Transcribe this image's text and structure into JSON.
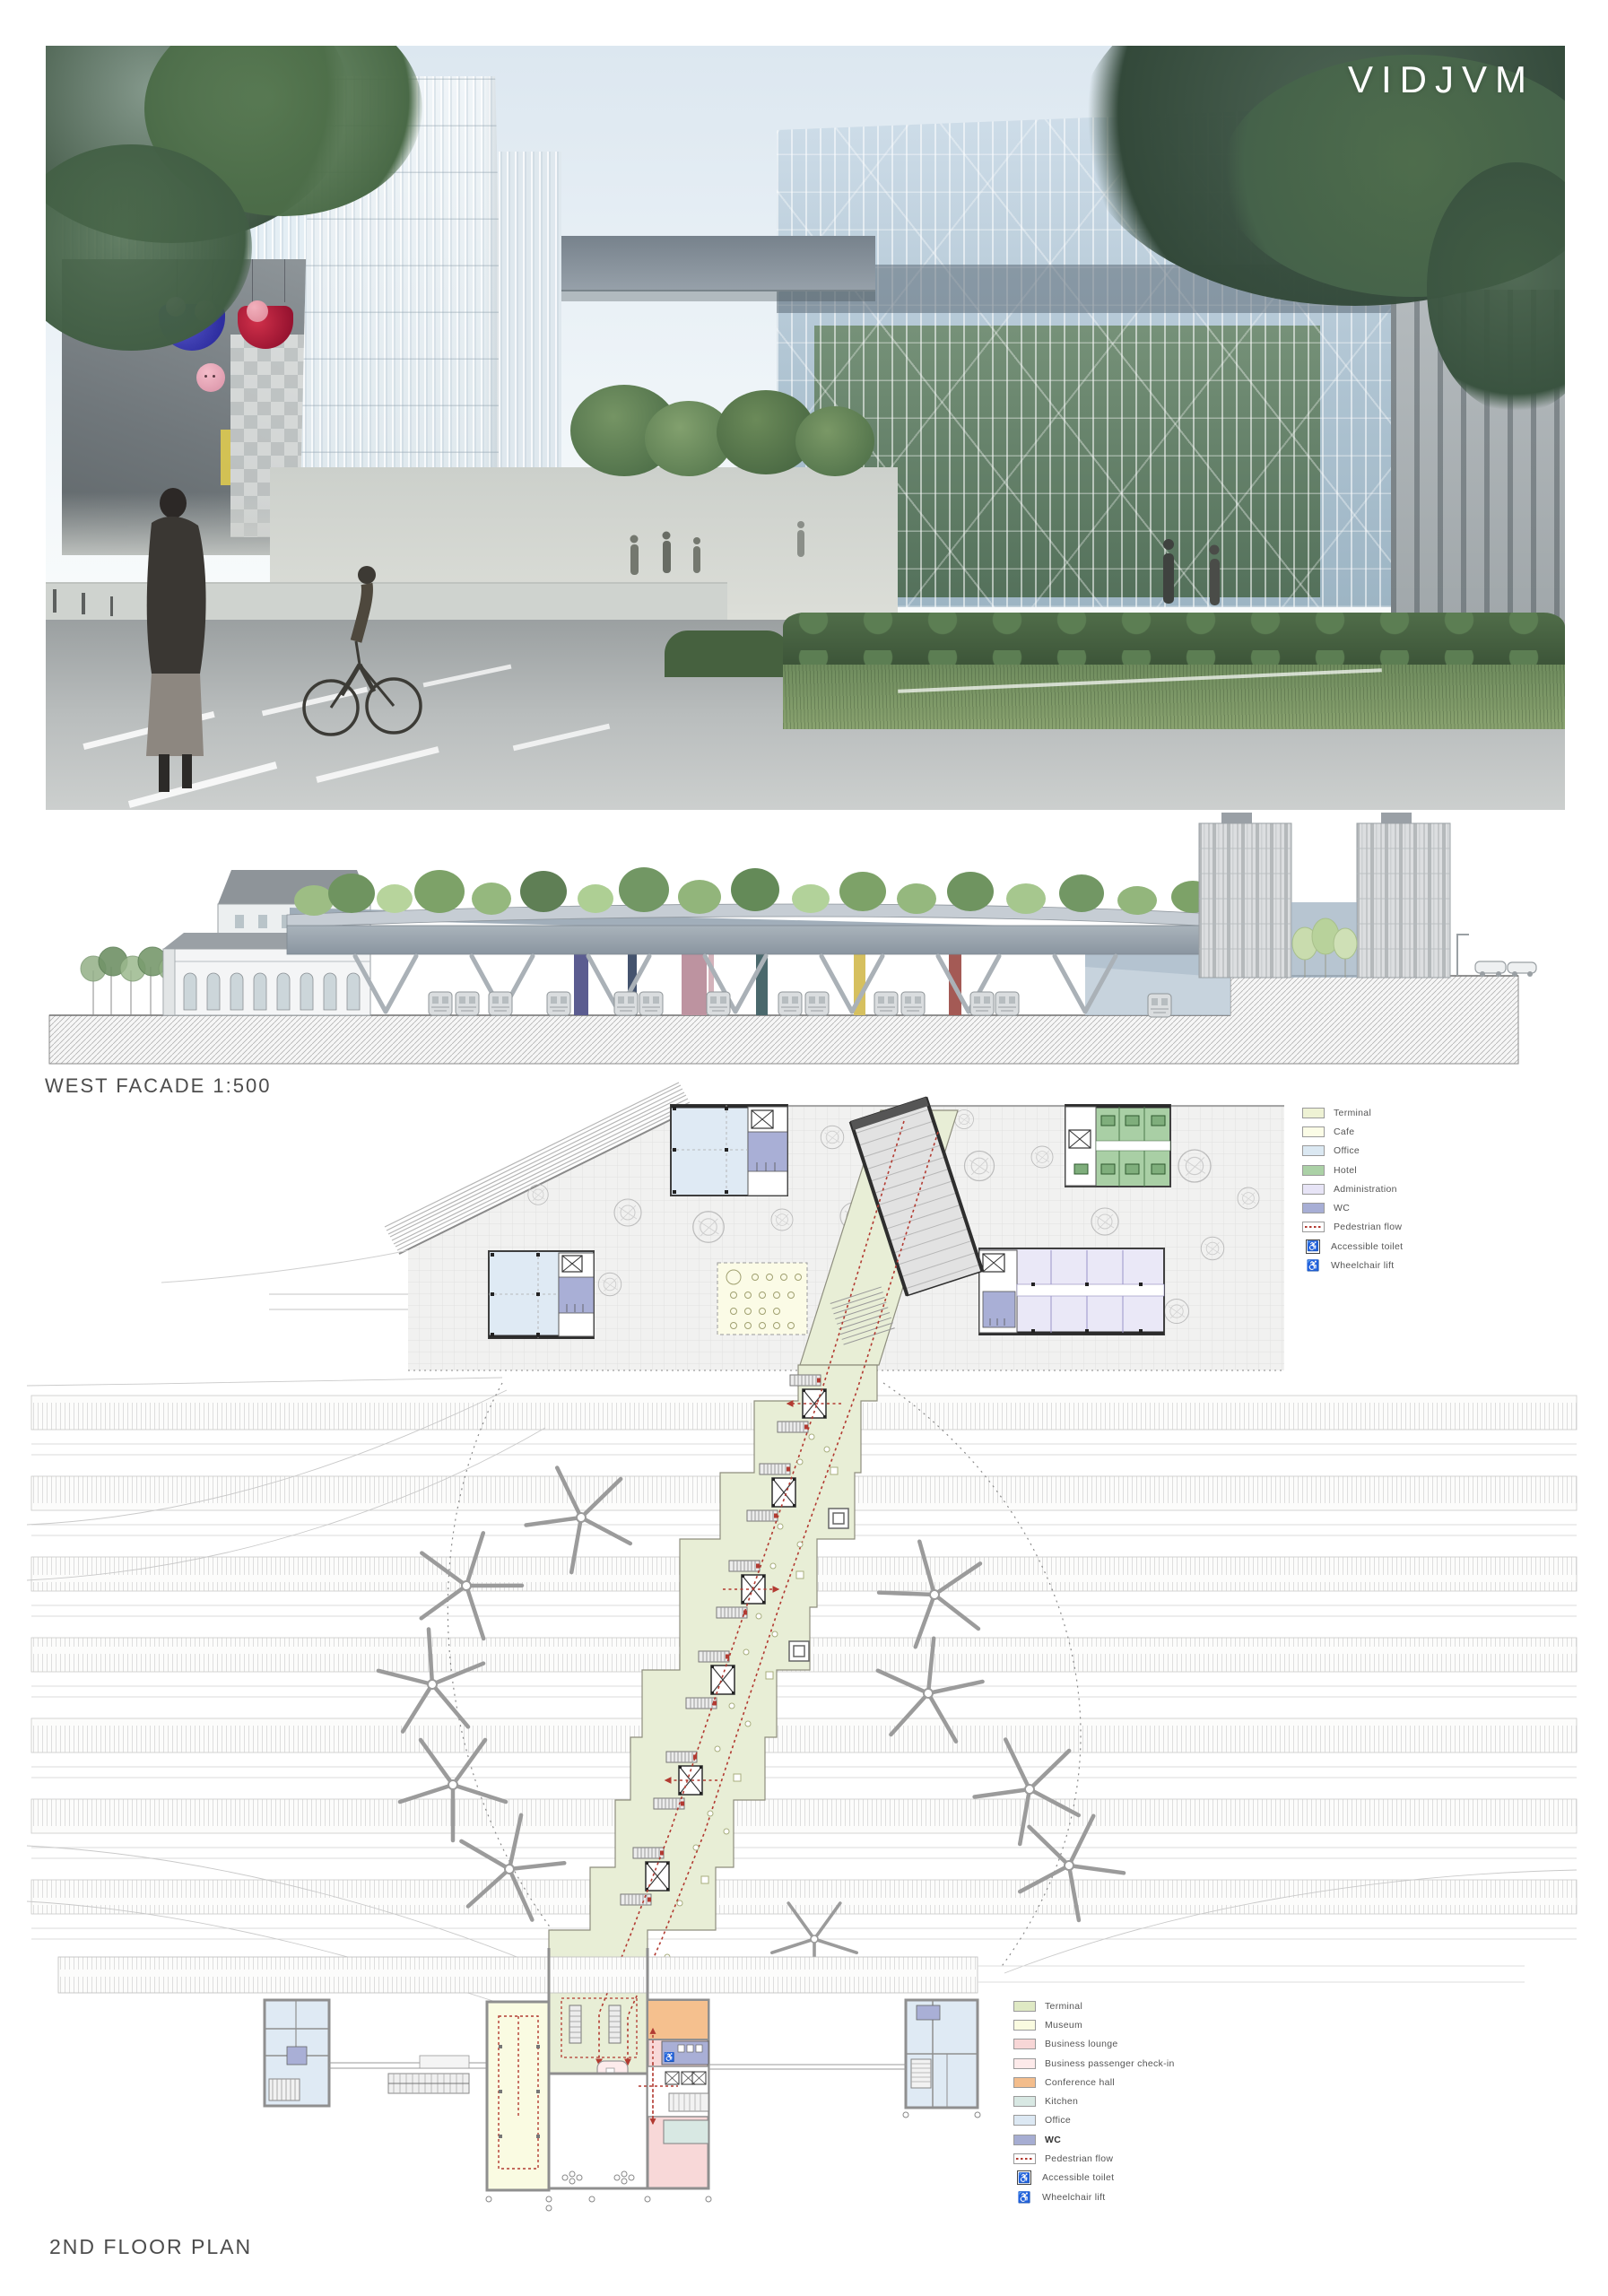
{
  "watermark": "VIDJVM",
  "elevation": {
    "label": "WEST FACADE 1:500"
  },
  "plan": {
    "label": "2ND FLOOR PLAN"
  },
  "icons": {
    "wheelchair": "♿"
  },
  "legend_top": {
    "items": [
      {
        "label": "Terminal",
        "color": "#eef2d4",
        "type": "swatch"
      },
      {
        "label": "Cafe",
        "color": "#fbfce6",
        "type": "swatch"
      },
      {
        "label": "Office",
        "color": "#dbe8f2",
        "type": "swatch"
      },
      {
        "label": "Hotel",
        "color": "#abd1a6",
        "type": "swatch"
      },
      {
        "label": "Administration",
        "color": "#e7e4f6",
        "type": "swatch"
      },
      {
        "label": "WC",
        "color": "#a7aed5",
        "type": "swatch"
      },
      {
        "label": "Pedestrian flow",
        "color": "#b23a31",
        "type": "flow-line"
      },
      {
        "label": "Accessible toilet",
        "type": "icon-boxed",
        "icon": "wheelchair"
      },
      {
        "label": "Wheelchair lift",
        "type": "icon",
        "icon": "wheelchair"
      }
    ]
  },
  "legend_bottom": {
    "items": [
      {
        "label": "Terminal",
        "color": "#dfe9c4",
        "type": "swatch"
      },
      {
        "label": "Museum",
        "color": "#fafbe0",
        "type": "swatch"
      },
      {
        "label": "Business lounge",
        "color": "#f7d6d6",
        "type": "swatch"
      },
      {
        "label": "Business passenger check-in",
        "color": "#fdeaea",
        "type": "swatch"
      },
      {
        "label": "Conference hall",
        "color": "#f3bd8c",
        "type": "swatch"
      },
      {
        "label": "Kitchen",
        "color": "#d8e8e3",
        "type": "swatch"
      },
      {
        "label": "Office",
        "color": "#dce8f3",
        "type": "swatch"
      },
      {
        "label": "WC",
        "color": "#a6add2",
        "type": "swatch"
      },
      {
        "label": "Pedestrian flow",
        "color": "#b23a31",
        "type": "flow-line"
      },
      {
        "label": "Accessible toilet",
        "type": "icon-boxed",
        "icon": "wheelchair"
      },
      {
        "label": "Wheelchair lift",
        "type": "icon",
        "icon": "wheelchair"
      }
    ]
  }
}
